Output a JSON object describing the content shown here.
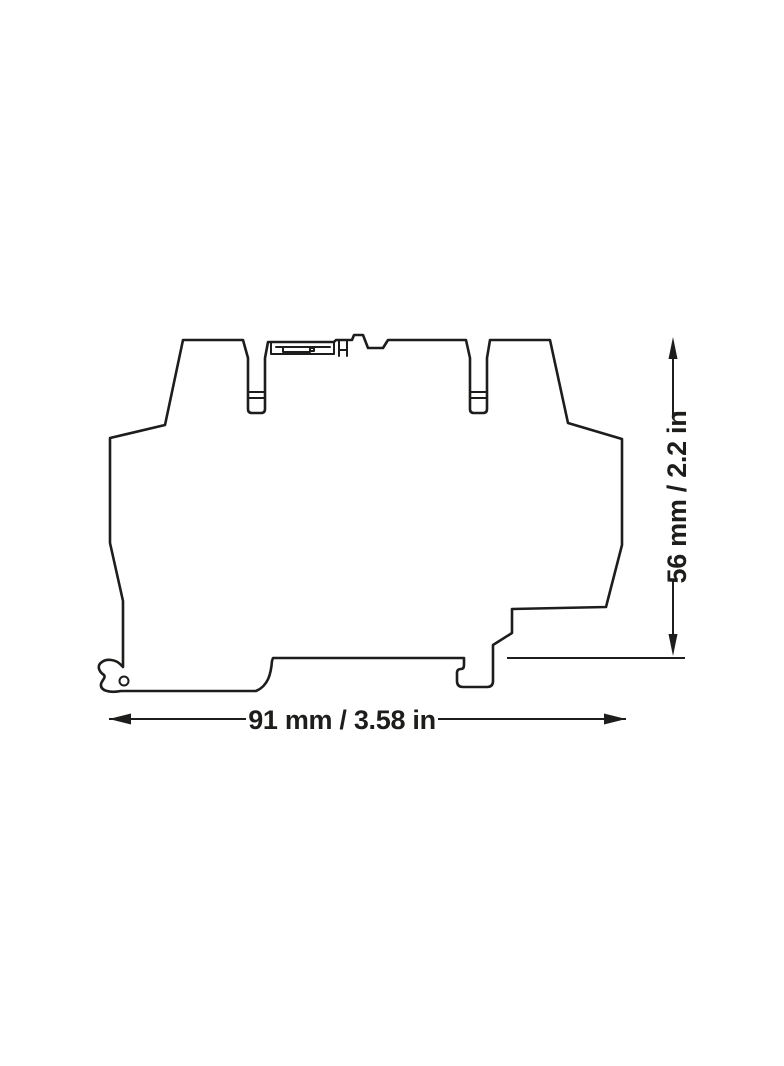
{
  "drawing": {
    "dimensions": {
      "width": {
        "label": "91 mm / 3.58 in"
      },
      "height": {
        "label": "56 mm / 2.2 in"
      }
    }
  },
  "colors": {
    "line": "#1d1d1b",
    "background": "#ffffff"
  }
}
